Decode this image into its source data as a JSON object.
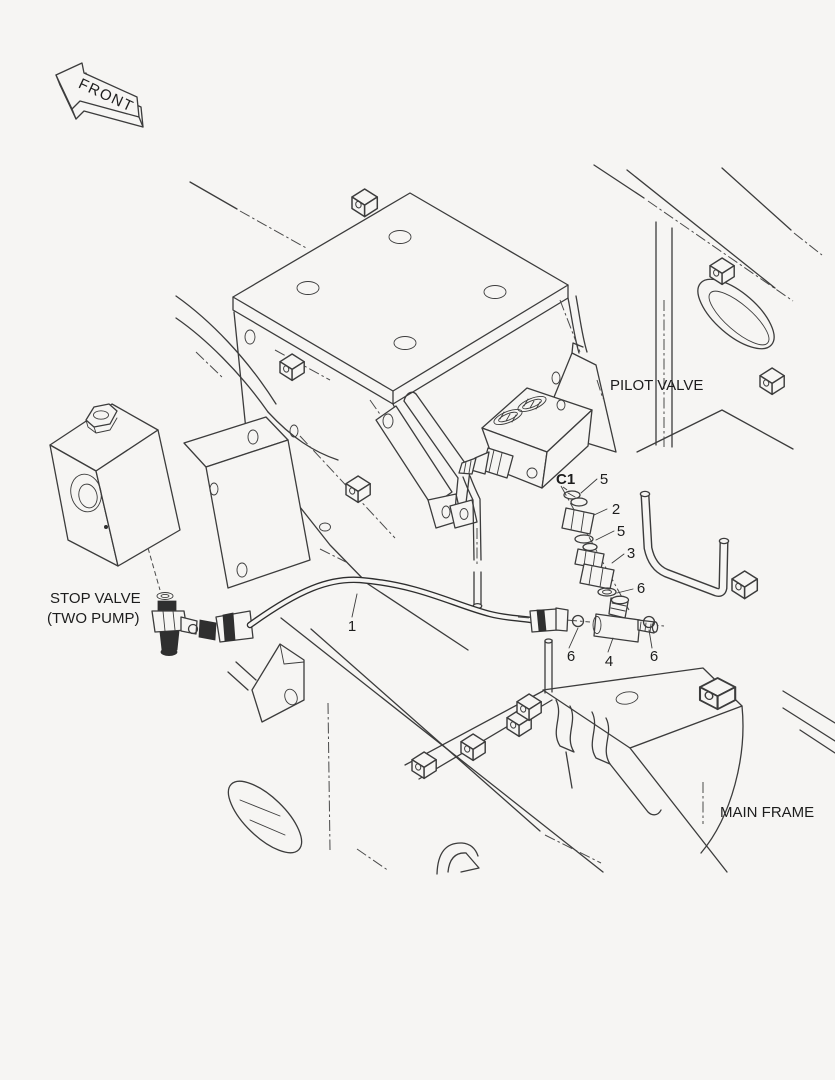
{
  "diagram": {
    "labels": {
      "front": "FRONT",
      "pilot_valve": "PILOT VALVE",
      "stop_valve_line1": "STOP VALVE",
      "stop_valve_line2": "(TWO PUMP)",
      "main_frame": "MAIN FRAME",
      "port": "C1"
    },
    "callouts": [
      {
        "ref": "1"
      },
      {
        "ref": "5"
      },
      {
        "ref": "2"
      },
      {
        "ref": "5"
      },
      {
        "ref": "3"
      },
      {
        "ref": "6"
      },
      {
        "ref": "6"
      },
      {
        "ref": "4"
      },
      {
        "ref": "6"
      }
    ],
    "colors": {
      "background": "#f6f5f3",
      "line": "#3c3c3c",
      "dark_fitting": "#2f2f2f"
    }
  }
}
